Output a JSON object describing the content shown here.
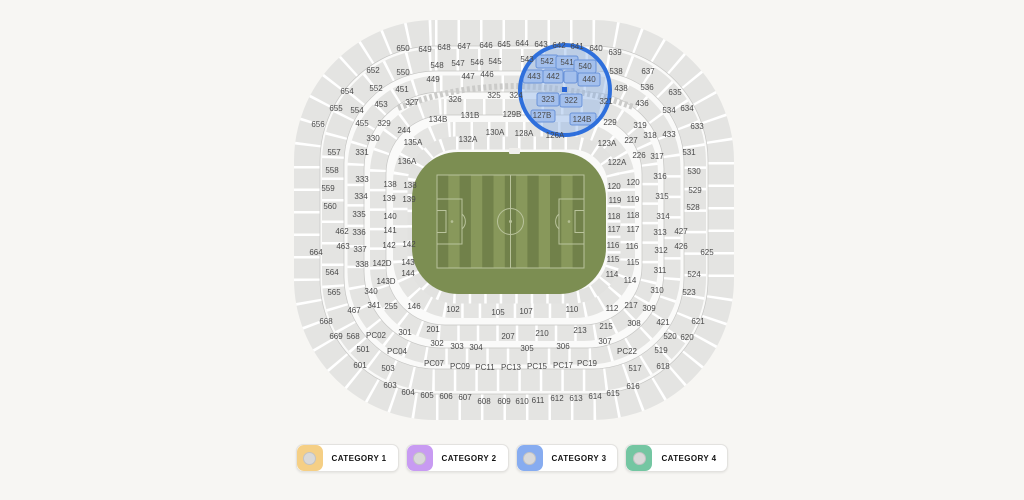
{
  "map": {
    "field": {
      "base_color": "#7c8e52",
      "stripe_light": "#88985b",
      "stripe_dark": "#71814a",
      "line_color": "#b9c39c"
    },
    "magnifier": {
      "cx": 565,
      "cy": 90,
      "r": 45,
      "ring_color": "#2e6fdc",
      "tint_color": "#8fb4e8",
      "block_fill": "#a3bfec",
      "block_stroke": "#6a93d9"
    },
    "selected_seat_marker": {
      "x": 562,
      "y": 87,
      "size": 5,
      "color": "#2563d6"
    },
    "highlighted_sections": [
      "542",
      "541",
      "540",
      "443",
      "442",
      "440",
      "323",
      "322",
      "127B",
      "124B"
    ],
    "highlight_blocks": [
      {
        "x": 536,
        "y": 55,
        "w": 22,
        "h": 13
      },
      {
        "x": 556,
        "y": 56,
        "w": 22,
        "h": 13
      },
      {
        "x": 574,
        "y": 60,
        "w": 22,
        "h": 13
      },
      {
        "x": 523,
        "y": 70,
        "w": 20,
        "h": 13
      },
      {
        "x": 543,
        "y": 70,
        "w": 20,
        "h": 13
      },
      {
        "x": 564,
        "y": 71,
        "w": 13,
        "h": 12
      },
      {
        "x": 578,
        "y": 73,
        "w": 22,
        "h": 13
      },
      {
        "x": 537,
        "y": 93,
        "w": 22,
        "h": 13
      },
      {
        "x": 560,
        "y": 94,
        "w": 22,
        "h": 13
      },
      {
        "x": 531,
        "y": 110,
        "w": 24,
        "h": 12
      },
      {
        "x": 570,
        "y": 113,
        "w": 26,
        "h": 12
      }
    ],
    "sections": [
      {
        "t": "650",
        "x": 403,
        "y": 49
      },
      {
        "t": "649",
        "x": 425,
        "y": 50
      },
      {
        "t": "648",
        "x": 444,
        "y": 48
      },
      {
        "t": "647",
        "x": 464,
        "y": 47
      },
      {
        "t": "646",
        "x": 486,
        "y": 46
      },
      {
        "t": "645",
        "x": 504,
        "y": 45
      },
      {
        "t": "644",
        "x": 522,
        "y": 44
      },
      {
        "t": "643",
        "x": 541,
        "y": 45
      },
      {
        "t": "642",
        "x": 559,
        "y": 46
      },
      {
        "t": "641",
        "x": 577,
        "y": 47
      },
      {
        "t": "640",
        "x": 596,
        "y": 49
      },
      {
        "t": "639",
        "x": 615,
        "y": 53
      },
      {
        "t": "652",
        "x": 373,
        "y": 71
      },
      {
        "t": "654",
        "x": 347,
        "y": 92
      },
      {
        "t": "655",
        "x": 336,
        "y": 109
      },
      {
        "t": "656",
        "x": 318,
        "y": 125
      },
      {
        "t": "637",
        "x": 648,
        "y": 72
      },
      {
        "t": "635",
        "x": 675,
        "y": 93
      },
      {
        "t": "634",
        "x": 687,
        "y": 109
      },
      {
        "t": "633",
        "x": 697,
        "y": 127
      },
      {
        "t": "550",
        "x": 403,
        "y": 73
      },
      {
        "t": "548",
        "x": 437,
        "y": 66
      },
      {
        "t": "547",
        "x": 458,
        "y": 64
      },
      {
        "t": "546",
        "x": 477,
        "y": 63
      },
      {
        "t": "545",
        "x": 495,
        "y": 62
      },
      {
        "t": "543",
        "x": 527,
        "y": 60
      },
      {
        "t": "542",
        "x": 547,
        "y": 62
      },
      {
        "t": "541",
        "x": 567,
        "y": 63
      },
      {
        "t": "540",
        "x": 585,
        "y": 67
      },
      {
        "t": "538",
        "x": 616,
        "y": 72
      },
      {
        "t": "536",
        "x": 647,
        "y": 88
      },
      {
        "t": "534",
        "x": 669,
        "y": 111
      },
      {
        "t": "552",
        "x": 376,
        "y": 89
      },
      {
        "t": "554",
        "x": 357,
        "y": 111
      },
      {
        "t": "449",
        "x": 433,
        "y": 80
      },
      {
        "t": "447",
        "x": 468,
        "y": 77
      },
      {
        "t": "446",
        "x": 487,
        "y": 75
      },
      {
        "t": "443",
        "x": 534,
        "y": 77
      },
      {
        "t": "442",
        "x": 553,
        "y": 77
      },
      {
        "t": "440",
        "x": 589,
        "y": 80
      },
      {
        "t": "438",
        "x": 621,
        "y": 89
      },
      {
        "t": "436",
        "x": 642,
        "y": 104
      },
      {
        "t": "451",
        "x": 402,
        "y": 90
      },
      {
        "t": "453",
        "x": 381,
        "y": 105
      },
      {
        "t": "455",
        "x": 362,
        "y": 124
      },
      {
        "t": "327",
        "x": 412,
        "y": 103
      },
      {
        "t": "326",
        "x": 455,
        "y": 100
      },
      {
        "t": "325",
        "x": 494,
        "y": 96
      },
      {
        "t": "324",
        "x": 516,
        "y": 96
      },
      {
        "t": "323",
        "x": 548,
        "y": 100
      },
      {
        "t": "322",
        "x": 571,
        "y": 101
      },
      {
        "t": "321",
        "x": 606,
        "y": 102
      },
      {
        "t": "329",
        "x": 384,
        "y": 124
      },
      {
        "t": "244",
        "x": 404,
        "y": 131
      },
      {
        "t": "319",
        "x": 640,
        "y": 126
      },
      {
        "t": "229",
        "x": 610,
        "y": 123
      },
      {
        "t": "134B",
        "x": 438,
        "y": 120
      },
      {
        "t": "131B",
        "x": 470,
        "y": 116
      },
      {
        "t": "129B",
        "x": 512,
        "y": 115
      },
      {
        "t": "127B",
        "x": 542,
        "y": 116
      },
      {
        "t": "124B",
        "x": 582,
        "y": 120
      },
      {
        "t": "135A",
        "x": 413,
        "y": 143
      },
      {
        "t": "136A",
        "x": 407,
        "y": 162
      },
      {
        "t": "132A",
        "x": 468,
        "y": 140
      },
      {
        "t": "130A",
        "x": 495,
        "y": 133
      },
      {
        "t": "128A",
        "x": 524,
        "y": 134
      },
      {
        "t": "126A",
        "x": 555,
        "y": 136
      },
      {
        "t": "123A",
        "x": 607,
        "y": 144
      },
      {
        "t": "122A",
        "x": 617,
        "y": 163
      },
      {
        "t": "557",
        "x": 334,
        "y": 153
      },
      {
        "t": "558",
        "x": 332,
        "y": 171
      },
      {
        "t": "559",
        "x": 328,
        "y": 189
      },
      {
        "t": "560",
        "x": 330,
        "y": 207
      },
      {
        "t": "462",
        "x": 342,
        "y": 232
      },
      {
        "t": "463",
        "x": 343,
        "y": 247
      },
      {
        "t": "664",
        "x": 316,
        "y": 253
      },
      {
        "t": "564",
        "x": 332,
        "y": 273
      },
      {
        "t": "565",
        "x": 334,
        "y": 293
      },
      {
        "t": "467",
        "x": 354,
        "y": 311
      },
      {
        "t": "668",
        "x": 326,
        "y": 322
      },
      {
        "t": "669",
        "x": 336,
        "y": 337
      },
      {
        "t": "568",
        "x": 353,
        "y": 337
      },
      {
        "t": "330",
        "x": 373,
        "y": 139
      },
      {
        "t": "331",
        "x": 362,
        "y": 153
      },
      {
        "t": "333",
        "x": 362,
        "y": 180
      },
      {
        "t": "334",
        "x": 361,
        "y": 197
      },
      {
        "t": "335",
        "x": 359,
        "y": 215
      },
      {
        "t": "336",
        "x": 359,
        "y": 233
      },
      {
        "t": "337",
        "x": 360,
        "y": 250
      },
      {
        "t": "338",
        "x": 362,
        "y": 265
      },
      {
        "t": "340",
        "x": 371,
        "y": 292
      },
      {
        "t": "341",
        "x": 374,
        "y": 306
      },
      {
        "t": "255",
        "x": 391,
        "y": 307
      },
      {
        "t": "138",
        "x": 390,
        "y": 185
      },
      {
        "t": "138",
        "x": 410,
        "y": 186
      },
      {
        "t": "139",
        "x": 389,
        "y": 199
      },
      {
        "t": "139",
        "x": 409,
        "y": 200
      },
      {
        "t": "140",
        "x": 390,
        "y": 217
      },
      {
        "t": "141",
        "x": 390,
        "y": 231
      },
      {
        "t": "142",
        "x": 389,
        "y": 246
      },
      {
        "t": "142",
        "x": 409,
        "y": 245
      },
      {
        "t": "142D",
        "x": 382,
        "y": 264
      },
      {
        "t": "143",
        "x": 408,
        "y": 263
      },
      {
        "t": "143D",
        "x": 386,
        "y": 282
      },
      {
        "t": "144",
        "x": 408,
        "y": 274
      },
      {
        "t": "146",
        "x": 414,
        "y": 307
      },
      {
        "t": "120",
        "x": 614,
        "y": 187
      },
      {
        "t": "120",
        "x": 633,
        "y": 183
      },
      {
        "t": "119",
        "x": 615,
        "y": 201
      },
      {
        "t": "119",
        "x": 633,
        "y": 200
      },
      {
        "t": "118",
        "x": 614,
        "y": 217
      },
      {
        "t": "118",
        "x": 633,
        "y": 216
      },
      {
        "t": "117",
        "x": 614,
        "y": 230
      },
      {
        "t": "117",
        "x": 633,
        "y": 230
      },
      {
        "t": "116",
        "x": 613,
        "y": 246
      },
      {
        "t": "116",
        "x": 632,
        "y": 247
      },
      {
        "t": "115",
        "x": 613,
        "y": 260
      },
      {
        "t": "115",
        "x": 633,
        "y": 263
      },
      {
        "t": "114",
        "x": 612,
        "y": 275
      },
      {
        "t": "114",
        "x": 630,
        "y": 281
      },
      {
        "t": "112",
        "x": 612,
        "y": 309
      },
      {
        "t": "227",
        "x": 631,
        "y": 141
      },
      {
        "t": "318",
        "x": 650,
        "y": 136
      },
      {
        "t": "433",
        "x": 669,
        "y": 135
      },
      {
        "t": "226",
        "x": 639,
        "y": 156
      },
      {
        "t": "317",
        "x": 657,
        "y": 157
      },
      {
        "t": "316",
        "x": 660,
        "y": 177
      },
      {
        "t": "315",
        "x": 662,
        "y": 197
      },
      {
        "t": "314",
        "x": 663,
        "y": 217
      },
      {
        "t": "313",
        "x": 660,
        "y": 233
      },
      {
        "t": "312",
        "x": 661,
        "y": 251
      },
      {
        "t": "311",
        "x": 660,
        "y": 271
      },
      {
        "t": "310",
        "x": 657,
        "y": 291
      },
      {
        "t": "309",
        "x": 649,
        "y": 309
      },
      {
        "t": "308",
        "x": 634,
        "y": 324
      },
      {
        "t": "217",
        "x": 631,
        "y": 306
      },
      {
        "t": "531",
        "x": 689,
        "y": 153
      },
      {
        "t": "530",
        "x": 694,
        "y": 172
      },
      {
        "t": "529",
        "x": 695,
        "y": 191
      },
      {
        "t": "528",
        "x": 693,
        "y": 208
      },
      {
        "t": "427",
        "x": 681,
        "y": 232
      },
      {
        "t": "426",
        "x": 681,
        "y": 247
      },
      {
        "t": "625",
        "x": 707,
        "y": 253
      },
      {
        "t": "524",
        "x": 694,
        "y": 275
      },
      {
        "t": "523",
        "x": 689,
        "y": 293
      },
      {
        "t": "421",
        "x": 663,
        "y": 323
      },
      {
        "t": "621",
        "x": 698,
        "y": 322
      },
      {
        "t": "620",
        "x": 687,
        "y": 338
      },
      {
        "t": "520",
        "x": 670,
        "y": 337
      },
      {
        "t": "519",
        "x": 661,
        "y": 351
      },
      {
        "t": "618",
        "x": 663,
        "y": 367
      },
      {
        "t": "517",
        "x": 635,
        "y": 369
      },
      {
        "t": "616",
        "x": 633,
        "y": 387
      },
      {
        "t": "102",
        "x": 453,
        "y": 310
      },
      {
        "t": "105",
        "x": 498,
        "y": 313
      },
      {
        "t": "107",
        "x": 526,
        "y": 312
      },
      {
        "t": "110",
        "x": 572,
        "y": 310
      },
      {
        "t": "201",
        "x": 433,
        "y": 330
      },
      {
        "t": "207",
        "x": 508,
        "y": 337
      },
      {
        "t": "210",
        "x": 542,
        "y": 334
      },
      {
        "t": "213",
        "x": 580,
        "y": 331
      },
      {
        "t": "215",
        "x": 606,
        "y": 327
      },
      {
        "t": "301",
        "x": 405,
        "y": 333
      },
      {
        "t": "302",
        "x": 437,
        "y": 344
      },
      {
        "t": "303",
        "x": 457,
        "y": 347
      },
      {
        "t": "304",
        "x": 476,
        "y": 348
      },
      {
        "t": "305",
        "x": 527,
        "y": 349
      },
      {
        "t": "306",
        "x": 563,
        "y": 347
      },
      {
        "t": "307",
        "x": 605,
        "y": 342
      },
      {
        "t": "PC02",
        "x": 376,
        "y": 336
      },
      {
        "t": "PC04",
        "x": 397,
        "y": 352
      },
      {
        "t": "PC07",
        "x": 434,
        "y": 364
      },
      {
        "t": "PC09",
        "x": 460,
        "y": 367
      },
      {
        "t": "PC11",
        "x": 485,
        "y": 368
      },
      {
        "t": "PC13",
        "x": 511,
        "y": 368
      },
      {
        "t": "PC15",
        "x": 537,
        "y": 367
      },
      {
        "t": "PC17",
        "x": 563,
        "y": 366
      },
      {
        "t": "PC19",
        "x": 587,
        "y": 364
      },
      {
        "t": "PC22",
        "x": 627,
        "y": 352
      },
      {
        "t": "501",
        "x": 363,
        "y": 350
      },
      {
        "t": "503",
        "x": 388,
        "y": 369
      },
      {
        "t": "601",
        "x": 360,
        "y": 366
      },
      {
        "t": "603",
        "x": 390,
        "y": 386
      },
      {
        "t": "604",
        "x": 408,
        "y": 393
      },
      {
        "t": "605",
        "x": 427,
        "y": 396
      },
      {
        "t": "606",
        "x": 446,
        "y": 397
      },
      {
        "t": "607",
        "x": 465,
        "y": 398
      },
      {
        "t": "608",
        "x": 484,
        "y": 402
      },
      {
        "t": "609",
        "x": 504,
        "y": 402
      },
      {
        "t": "610",
        "x": 522,
        "y": 402
      },
      {
        "t": "611",
        "x": 538,
        "y": 401
      },
      {
        "t": "612",
        "x": 557,
        "y": 399
      },
      {
        "t": "613",
        "x": 576,
        "y": 399
      },
      {
        "t": "614",
        "x": 595,
        "y": 397
      },
      {
        "t": "615",
        "x": 613,
        "y": 394
      }
    ]
  },
  "legend": {
    "items": [
      {
        "label": "CATEGORY 1",
        "color": "#f5cf85"
      },
      {
        "label": "CATEGORY 2",
        "color": "#c89bf2"
      },
      {
        "label": "CATEGORY 3",
        "color": "#87acf0"
      },
      {
        "label": "CATEGORY 4",
        "color": "#74c6a2"
      }
    ]
  }
}
